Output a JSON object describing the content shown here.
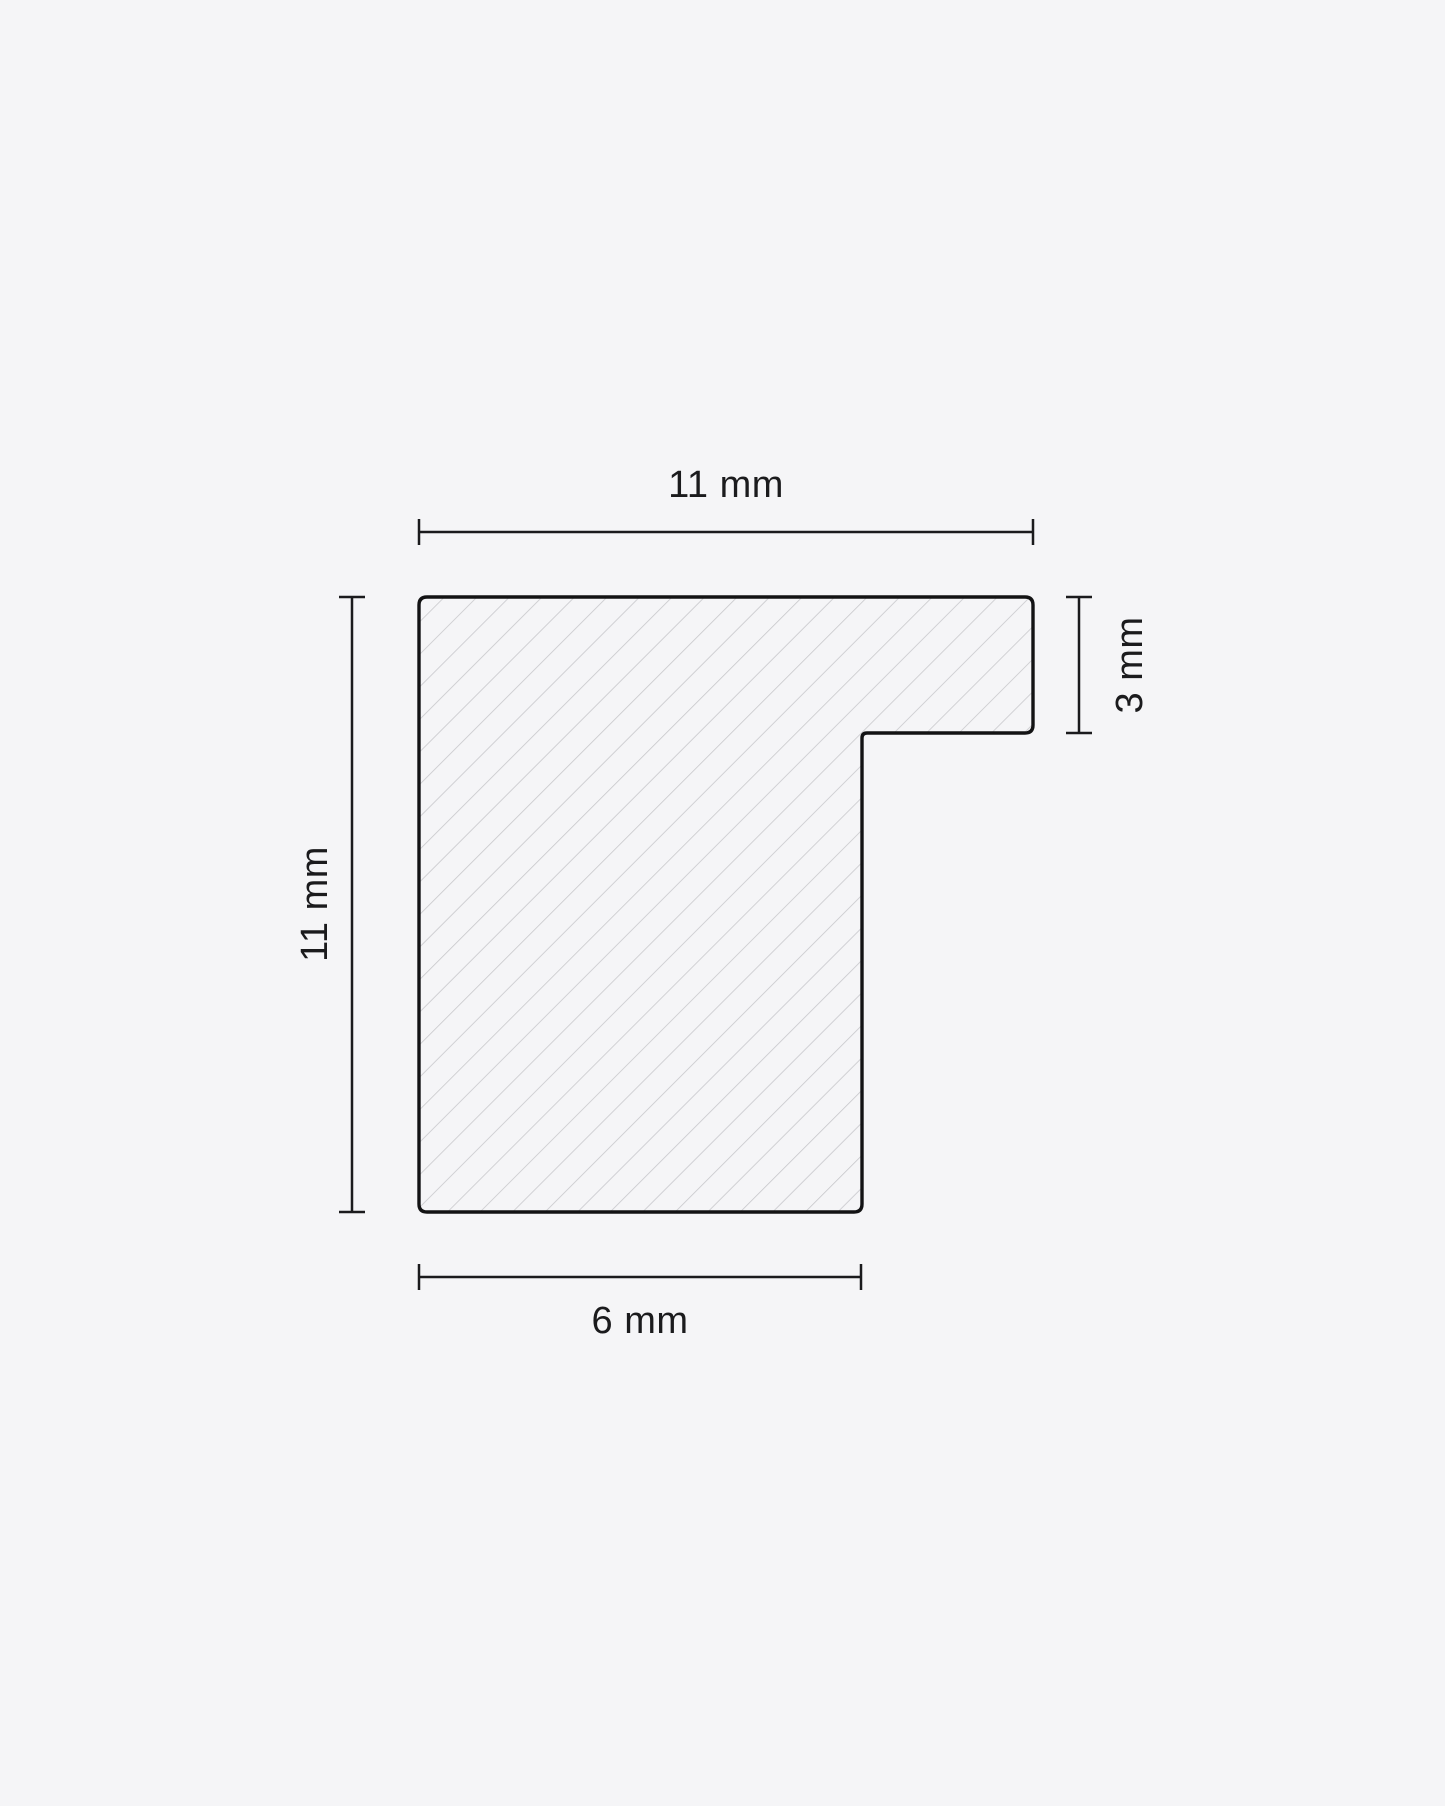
{
  "diagram": {
    "name": "moulding-profile-cross-section",
    "dimensions": {
      "top": "11 mm",
      "left": "11 mm",
      "right": "3 mm",
      "bottom": "6 mm"
    },
    "colors": {
      "background": "#f5f5f7",
      "outline": "#131314",
      "hatch": "#c7c7cb",
      "dimension_lines": "#1b1b1d",
      "text": "#1b1b1d"
    }
  }
}
